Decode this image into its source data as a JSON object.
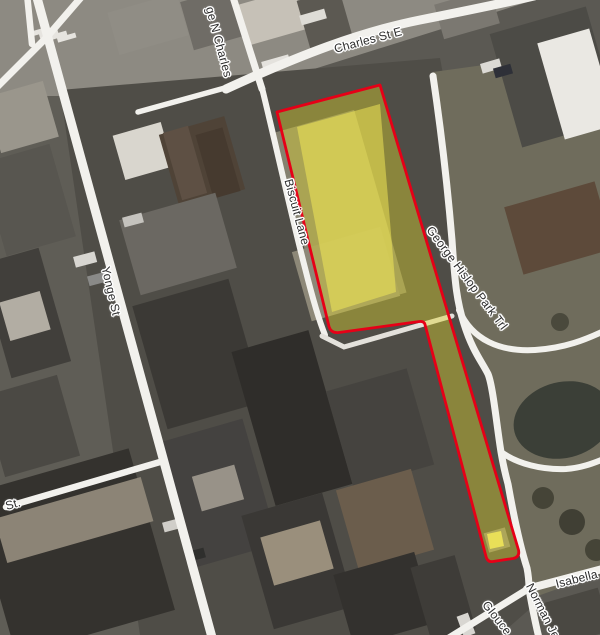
{
  "map": {
    "street_labels": [
      {
        "name": "Charles St E"
      },
      {
        "name": "ge N Charles"
      },
      {
        "name": "Biscuit Lane"
      },
      {
        "name": "Yonge St"
      },
      {
        "name": "George Hislop Park Trl"
      },
      {
        "name": "Isabella St"
      },
      {
        "name": "Norman Je"
      },
      {
        "name": "Glouce"
      },
      {
        "name": "St."
      }
    ],
    "parcel": {
      "fill_color": "#ddd32e",
      "outline_color": "#e60017",
      "highlight_building_color": "#f7ee58"
    },
    "road_color": "#f2f1ed"
  }
}
